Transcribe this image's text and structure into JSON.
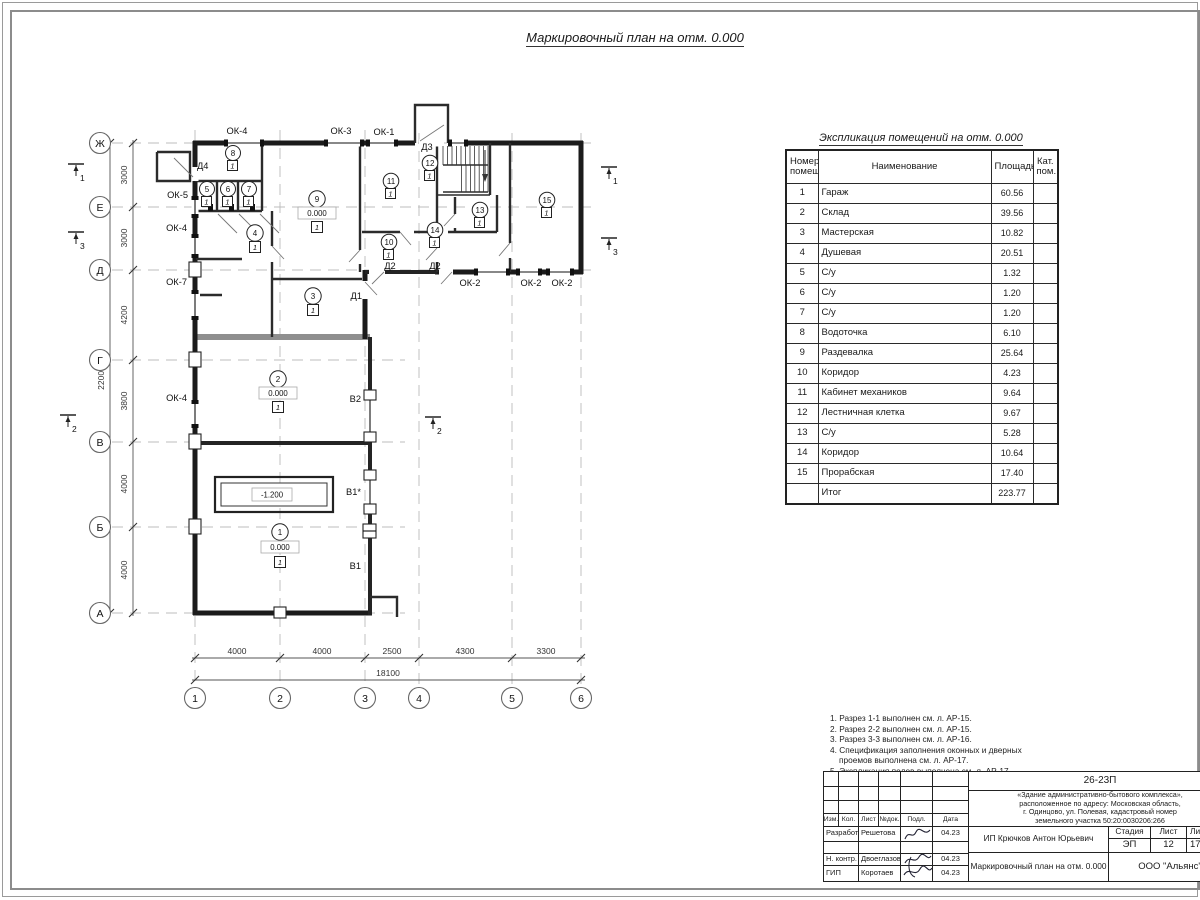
{
  "page_title": "Маркировочный план на отм. 0.000",
  "plan": {
    "row_axes": [
      "Ж",
      "Е",
      "Д",
      "Г",
      "В",
      "Б",
      "А"
    ],
    "col_axes": [
      "1",
      "2",
      "3",
      "4",
      "5",
      "6"
    ],
    "dims_left": [
      "3000",
      "3000",
      "4200",
      "3800",
      "4000",
      "4000"
    ],
    "dims_left_total": "22000",
    "dims_bottom": [
      "4000",
      "4000",
      "2500",
      "4300",
      "3300"
    ],
    "dims_bottom_total": "18100",
    "windows_top": [
      "ОК-4",
      "ОК-3",
      "ОК-1"
    ],
    "windows_left": [
      "ОК-5",
      "ОК-4",
      "ОК-7",
      "ОК-4"
    ],
    "windows_bottom": [
      "ОК-2",
      "ОК-2",
      "ОК-2"
    ],
    "doors": {
      "d4": "Д4",
      "d3": "Д3",
      "d2a": "Д2",
      "d2b": "Д2",
      "d1": "Д1"
    },
    "gates": {
      "v2": "В2",
      "v1s": "В1*",
      "v1": "В1"
    },
    "elev_zero": "0.000",
    "elev_pit": "-1.200",
    "floor_type": "1",
    "rooms": [
      "1",
      "2",
      "3",
      "4",
      "5",
      "6",
      "7",
      "8",
      "9",
      "10",
      "11",
      "12",
      "13",
      "14",
      "15"
    ],
    "sections": {
      "s1": "1",
      "s2": "2",
      "s3": "3"
    }
  },
  "schedule": {
    "title": "Экспликация помещений на отм. 0.000",
    "headers": {
      "num": "Номер помещ.",
      "name": "Наименование",
      "area": "Площадь",
      "cat": "Кат. пом."
    },
    "rows": [
      {
        "num": "1",
        "name": "Гараж",
        "area": "60.56"
      },
      {
        "num": "2",
        "name": "Склад",
        "area": "39.56"
      },
      {
        "num": "3",
        "name": "Мастерская",
        "area": "10.82"
      },
      {
        "num": "4",
        "name": "Душевая",
        "area": "20.51"
      },
      {
        "num": "5",
        "name": "С/у",
        "area": "1.32"
      },
      {
        "num": "6",
        "name": "С/у",
        "area": "1.20"
      },
      {
        "num": "7",
        "name": "С/у",
        "area": "1.20"
      },
      {
        "num": "8",
        "name": "Водоточка",
        "area": "6.10"
      },
      {
        "num": "9",
        "name": "Раздевалка",
        "area": "25.64"
      },
      {
        "num": "10",
        "name": "Коридор",
        "area": "4.23"
      },
      {
        "num": "11",
        "name": "Кабинет механиков",
        "area": "9.64"
      },
      {
        "num": "12",
        "name": "Лестничная клетка",
        "area": "9.67"
      },
      {
        "num": "13",
        "name": "С/у",
        "area": "5.28"
      },
      {
        "num": "14",
        "name": "Коридор",
        "area": "10.64"
      },
      {
        "num": "15",
        "name": "Прорабская",
        "area": "17.40"
      }
    ],
    "total_label": "Итог",
    "total_area": "223.77"
  },
  "notes": [
    "1. Разрез 1-1 выполнен см. л. АР-15.",
    "2. Разрез 2-2 выполнен см. л. АР-15.",
    "3. Разрез 3-3 выполнен см. л. АР-16.",
    "4. Спецификация заполнения оконных и дверных",
    "проемов выполнена см. л. АР-17.",
    "5. Экспликация полов выполнена см. л. АР-17."
  ],
  "titleblock": {
    "doc_number": "26-23П",
    "project_lines": [
      "«Здание административно-бытового комплекса»,",
      "расположенное по адресу: Московская область,",
      "г. Одинцово, ул. Полевая, кадастровый номер",
      "земельного участка 50:20:0030206:266"
    ],
    "cols": {
      "izm": "Изм.",
      "kol": "Кол.",
      "list": "Лист",
      "ndok": "№док.",
      "podl": "Подл.",
      "data": "Дата"
    },
    "rows": [
      {
        "role": "Разработал",
        "name": "Решетова",
        "date": "04.23"
      },
      {
        "role": "Н. контр.",
        "name": "Двоеглазов",
        "date": "04.23"
      },
      {
        "role": "ГИП",
        "name": "Коротаев",
        "date": "04.23"
      }
    ],
    "client": "ИП Крючков Антон Юрьевич",
    "stage_label": "Стадия",
    "sheet_label": "Лист",
    "sheets_label": "Листов",
    "stage": "ЭП",
    "sheet_num": "12",
    "sheets_total": "17",
    "drawing_title": "Маркировочный план на отм. 0.000",
    "company": "ООО \"Альянс\""
  }
}
